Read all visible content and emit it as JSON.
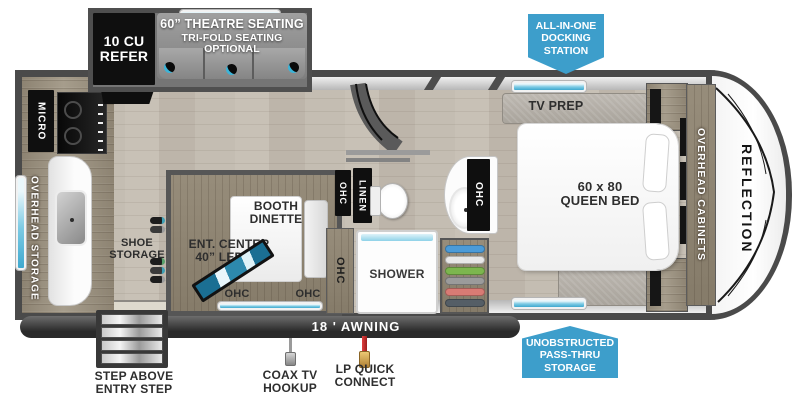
{
  "labels": {
    "refer": "10 CU\nREFER",
    "theatre1": "60” THEATRE SEATING",
    "theatre2": "TRI-FOLD SEATING OPTIONAL",
    "docking": "ALL-IN-ONE\nDOCKING\nSTATION",
    "micro": "MICRO",
    "overhead_storage": "OVERHEAD STORAGE",
    "shoe_storage": "SHOE\nSTORAGE",
    "booth_dinette": "BOOTH\nDINETTE",
    "ent_center": "ENT. CENTER\n40” LED TV",
    "ohc": "OHC",
    "linen": "LINEN",
    "shower": "SHOWER",
    "tv_prep": "TV PREP",
    "queen_bed": "60 x 80\nQUEEN BED",
    "overhead_cabinets": "OVERHEAD CABINETS",
    "reflection": "REFLECTION",
    "awning": "18 ' AWNING",
    "step": "STEP ABOVE\nENTRY STEP",
    "coax": "COAX TV\nHOOKUP",
    "lp": "LP QUICK\nCONNECT",
    "passthru": "UNOBSTRUCTED\nPASS-THRU\nSTORAGE"
  },
  "colors": {
    "badge_blue": "#3d9ecb",
    "wall_dark": "#4a4a4a",
    "floor_wood": "#c3bcb1",
    "cabinet_wood": "#948a79",
    "window_blue": "#7ecbe4",
    "fixture_black": "#0d0d0d"
  },
  "hangers": [
    "#4b9bd8",
    "#e8e8e8",
    "#7cb64e",
    "#9b9b9b",
    "#d97b74",
    "#555e66"
  ]
}
